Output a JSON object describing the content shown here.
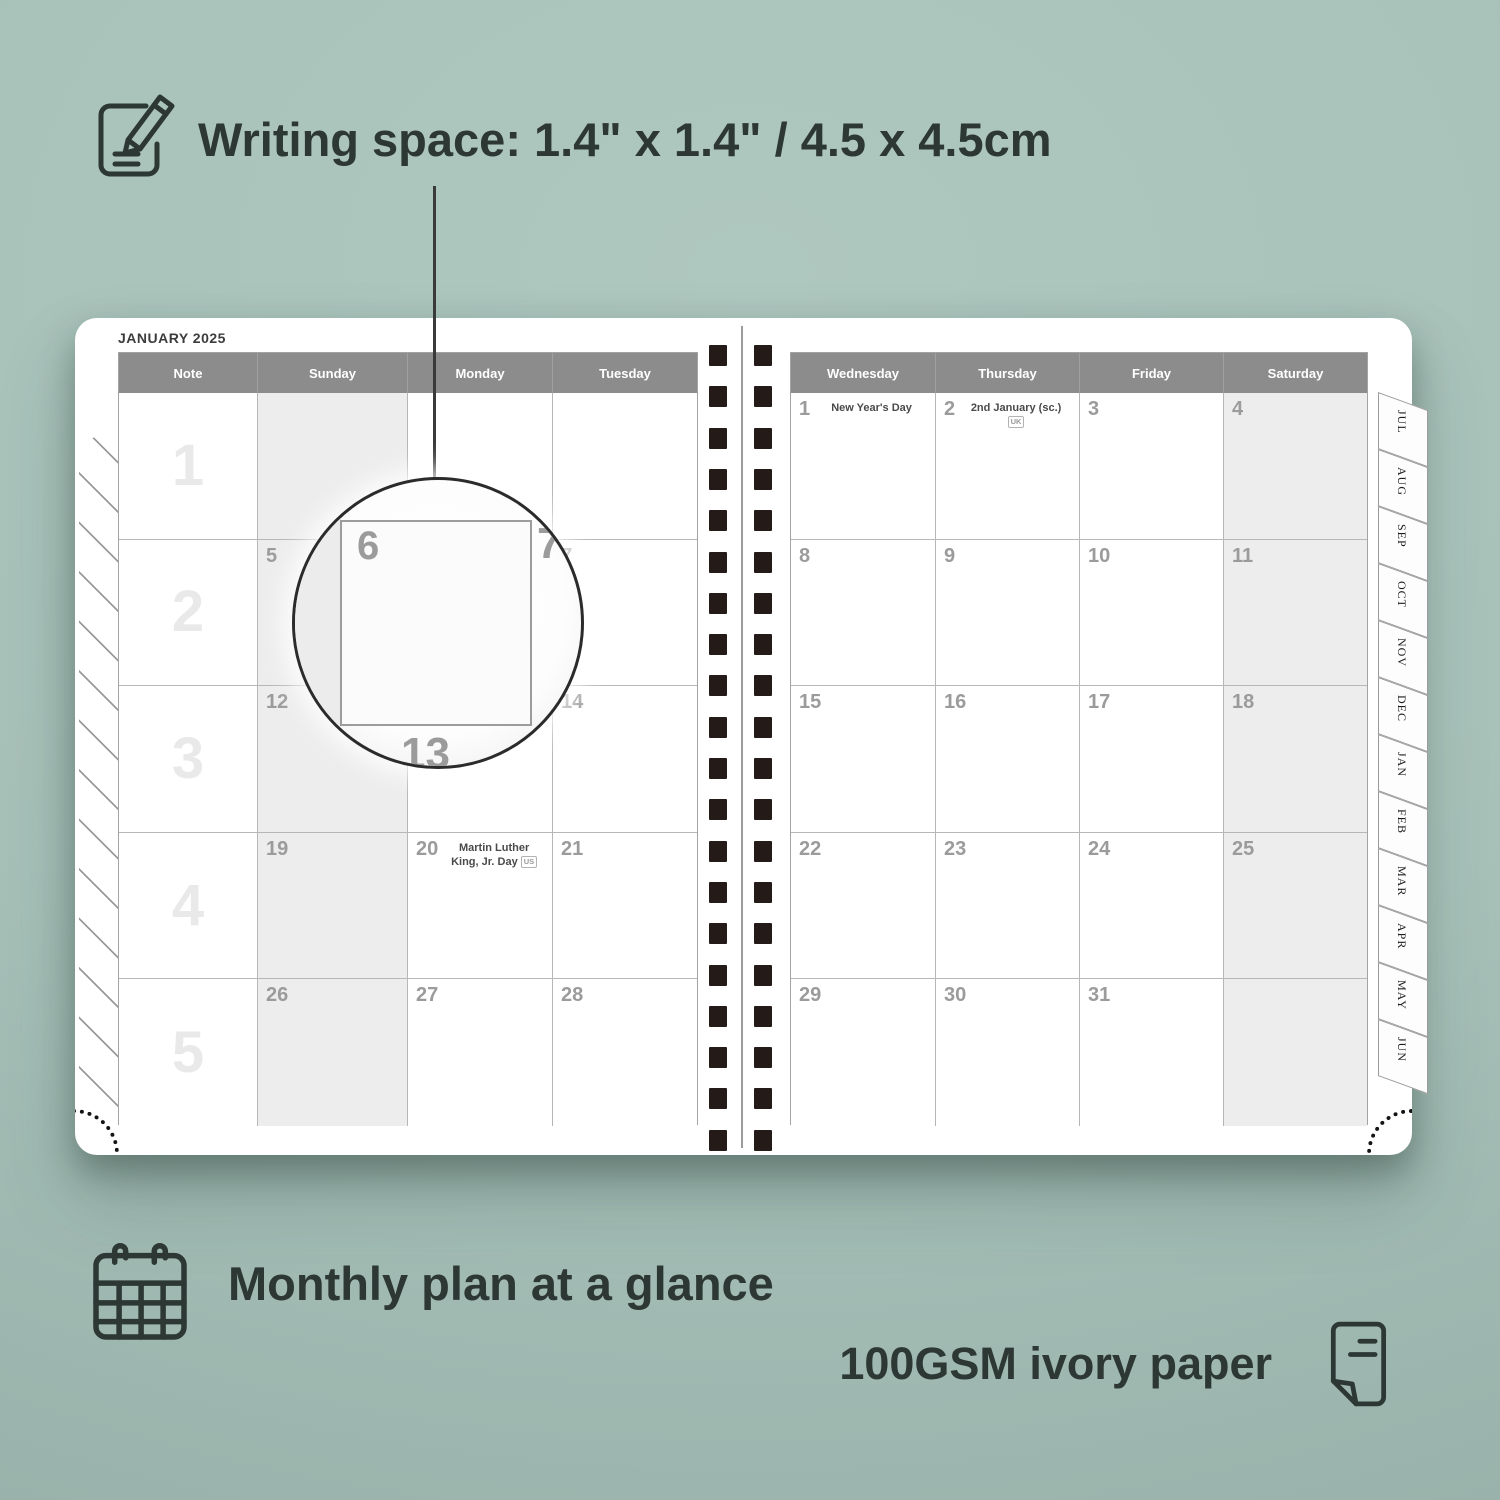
{
  "colors": {
    "background": "#a7c1b9",
    "ink": "#2d3733",
    "header_bg": "#8c8c8c",
    "shaded_column": "#ededed",
    "date_number": "#9b9b9b",
    "week_number": "#e9e9e9",
    "binding_coil": "#241b18"
  },
  "annotations": {
    "writing_space": "Writing space: 1.4\" x 1.4\" / 4.5 x 4.5cm",
    "monthly_plan": "Monthly plan at a glance",
    "paper": "100GSM ivory paper"
  },
  "planner": {
    "title": "JANUARY 2025",
    "left_headers": [
      "Note",
      "Sunday",
      "Monday",
      "Tuesday"
    ],
    "right_headers": [
      "Wednesday",
      "Thursday",
      "Friday",
      "Saturday"
    ],
    "week_numbers": [
      "1",
      "2",
      "3",
      "4",
      "5"
    ],
    "left_rows": [
      [
        {
          "d": ""
        },
        {
          "d": ""
        },
        {
          "d": ""
        }
      ],
      [
        {
          "d": "5"
        },
        {
          "d": "6"
        },
        {
          "d": "7"
        }
      ],
      [
        {
          "d": "12"
        },
        {
          "d": "13"
        },
        {
          "d": "14"
        }
      ],
      [
        {
          "d": "19"
        },
        {
          "d": "20",
          "h": "Martin Luther King, Jr. Day",
          "b": "US"
        },
        {
          "d": "21"
        }
      ],
      [
        {
          "d": "26"
        },
        {
          "d": "27"
        },
        {
          "d": "28"
        }
      ]
    ],
    "right_rows": [
      [
        {
          "d": "1",
          "h": "New Year's Day"
        },
        {
          "d": "2",
          "h": "2nd January (sc.)",
          "b": "UK"
        },
        {
          "d": "3"
        },
        {
          "d": "4"
        }
      ],
      [
        {
          "d": "8"
        },
        {
          "d": "9"
        },
        {
          "d": "10"
        },
        {
          "d": "11"
        }
      ],
      [
        {
          "d": "15"
        },
        {
          "d": "16"
        },
        {
          "d": "17"
        },
        {
          "d": "18"
        }
      ],
      [
        {
          "d": "22"
        },
        {
          "d": "23"
        },
        {
          "d": "24"
        },
        {
          "d": "25"
        }
      ],
      [
        {
          "d": "29"
        },
        {
          "d": "30"
        },
        {
          "d": "31"
        },
        {
          "d": ""
        }
      ]
    ],
    "tabs": [
      "JUL",
      "AUG",
      "SEP",
      "OCT",
      "NOV",
      "DEC",
      "JAN",
      "FEB",
      "MAR",
      "APR",
      "MAY",
      "JUN"
    ]
  },
  "magnifier": {
    "day": "6",
    "right_day": "7",
    "bottom_day": "13"
  }
}
